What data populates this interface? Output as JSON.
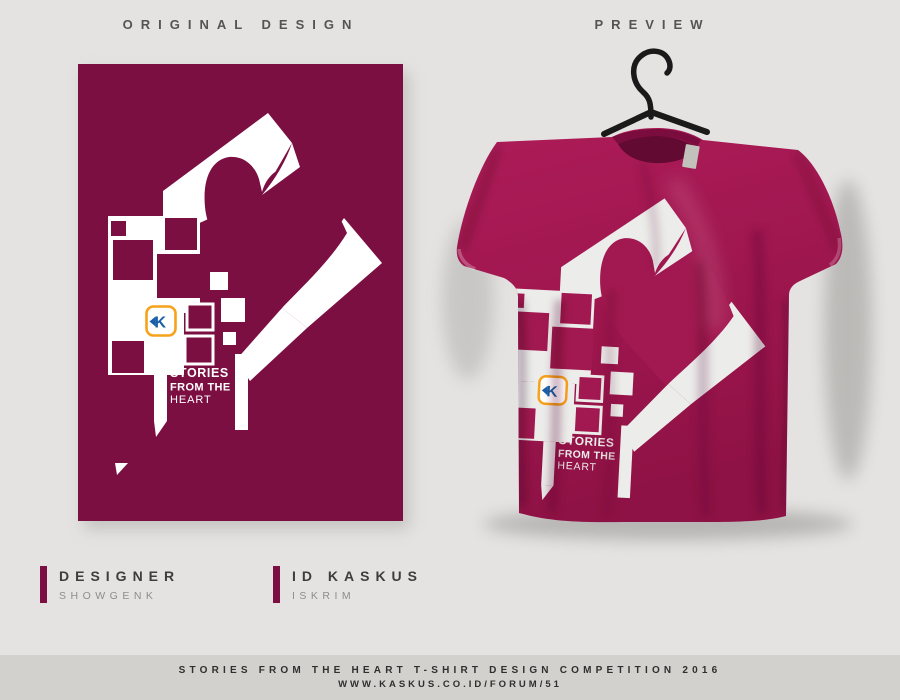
{
  "header": {
    "left_label": "ORIGINAL DESIGN",
    "right_label": "PREVIEW"
  },
  "design": {
    "line1": "STORIES",
    "line2": "FROM THE",
    "line3": "HEART",
    "logo_letter": "K"
  },
  "credits": {
    "designer_label": "DESIGNER",
    "designer_value": "SHOWGENK",
    "id_label": "ID KASKUS",
    "id_value": "ISKRIM"
  },
  "footer": {
    "line1": "STORIES FROM THE HEART T-SHIRT DESIGN COMPETITION 2016",
    "line2": "WWW.KASKUS.CO.ID/FORUM/51"
  },
  "colors": {
    "background": "#e4e3e1",
    "footer_bar": "#d2d1ce",
    "poster_maroon": "#7c0f42",
    "shirt_magenta": "#a21850",
    "print_white": "#ececeb",
    "logo_orange": "#f6a21b",
    "logo_blue": "#1b5fa8",
    "hanger": "#1a1a1a",
    "accent_bar": "#7c0f42",
    "header_text": "#545454",
    "muted_text": "#8f8d88"
  }
}
